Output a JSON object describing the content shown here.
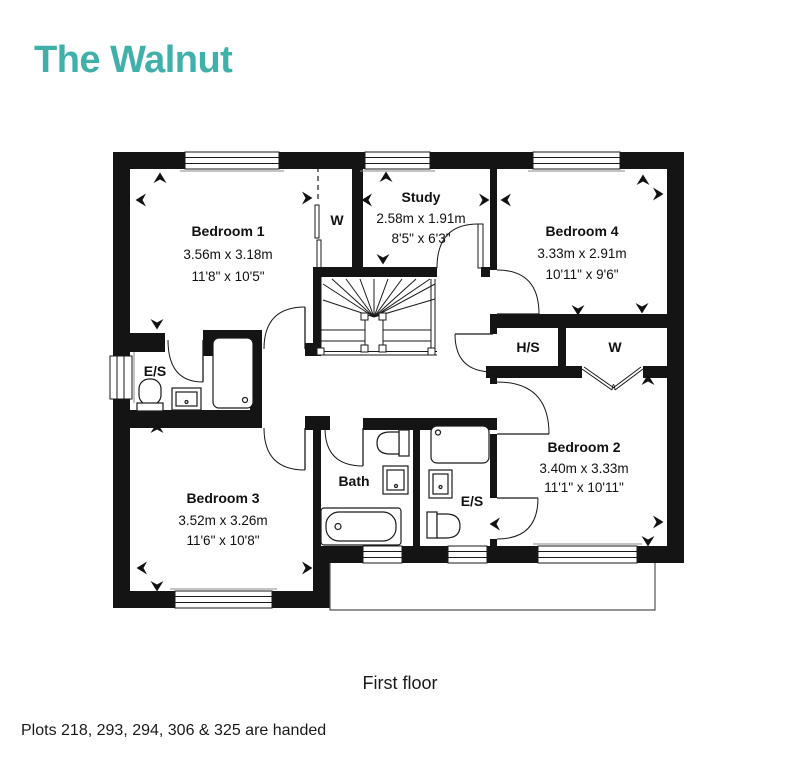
{
  "title": "The Walnut",
  "accent_color": "#40B0AB",
  "caption": "First floor",
  "footer_note": "Plots 218, 293, 294, 306 & 325 are handed",
  "plan": {
    "floor": "First floor",
    "rooms": {
      "bedroom1": {
        "name": "Bedroom 1",
        "metric": "3.56m x 3.18m",
        "imperial": "11'8\" x 10'5\""
      },
      "study": {
        "name": "Study",
        "metric": "2.58m x 1.91m",
        "imperial": "8'5\" x 6'3\""
      },
      "bedroom4": {
        "name": "Bedroom 4",
        "metric": "3.33m x 2.91m",
        "imperial": "10'11\" x 9'6\""
      },
      "bedroom2": {
        "name": "Bedroom 2",
        "metric": "3.40m x 3.33m",
        "imperial": "11'1\" x 10'11\""
      },
      "bedroom3": {
        "name": "Bedroom 3",
        "metric": "3.52m x 3.26m",
        "imperial": "11'6\" x 10'8\""
      },
      "bath": {
        "name": "Bath"
      },
      "es1": {
        "name": "E/S"
      },
      "es2": {
        "name": "E/S"
      },
      "hs": {
        "name": "H/S"
      },
      "w1": {
        "name": "W"
      },
      "w2": {
        "name": "W"
      }
    }
  }
}
